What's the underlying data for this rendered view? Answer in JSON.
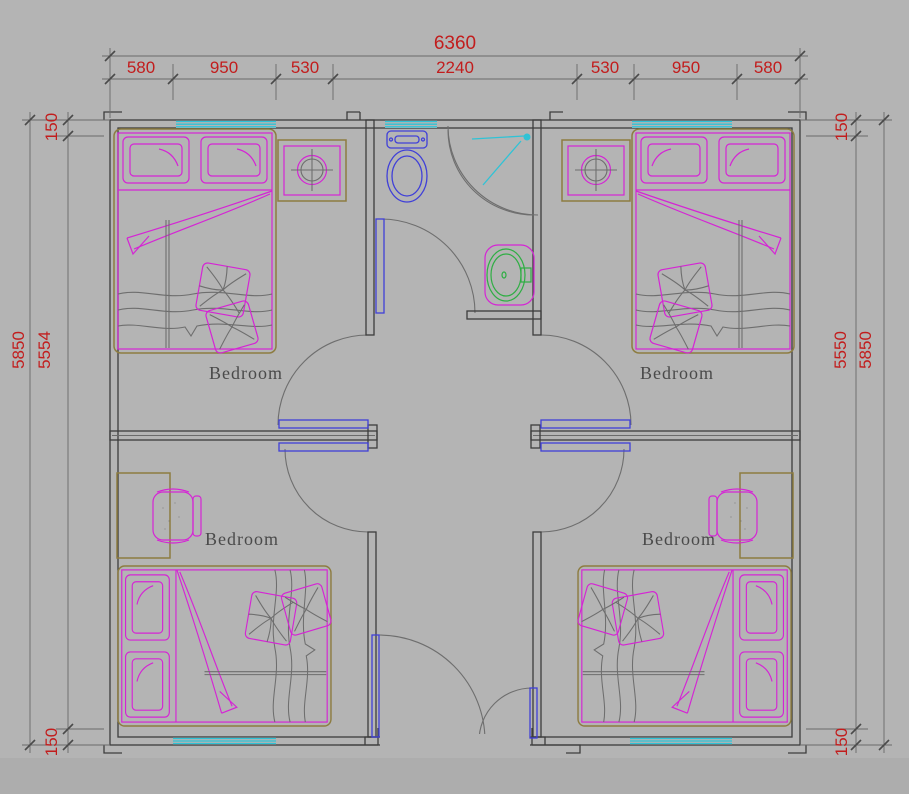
{
  "drawing": {
    "type": "architectural-floor-plan",
    "rooms": [
      {
        "label": "Bedroom"
      },
      {
        "label": "Bedroom"
      },
      {
        "label": "Bedroom"
      },
      {
        "label": "Bedroom"
      }
    ],
    "fixtures": [
      "double-bed",
      "double-bed",
      "double-bed",
      "double-bed",
      "bedside-table-with-lamp",
      "bedside-table-with-lamp",
      "desk-with-chair",
      "desk-with-chair",
      "toilet",
      "corner-shower",
      "washbasin",
      "window",
      "window",
      "window",
      "window",
      "window",
      "door-swing",
      "door-swing",
      "door-swing",
      "door-swing",
      "bathroom-door",
      "entry-double-door"
    ]
  },
  "dimensions": {
    "top": {
      "total": "6360",
      "segments": [
        "580",
        "950",
        "530",
        "2240",
        "530",
        "950",
        "580"
      ]
    },
    "left": {
      "overall": "5850",
      "chain": [
        "150",
        "5554",
        "150"
      ]
    },
    "right": {
      "overall": "5850",
      "chain": [
        "150",
        "5550",
        "150"
      ]
    }
  },
  "colors": {
    "background": "#b4b4b4",
    "wall": "#3d3d3d",
    "furniture_gray": "#6e6e6e",
    "dimension_red": "#c21d1d",
    "magenta": "#d524d5",
    "tan": "#8d7c40",
    "blue": "#4040d8",
    "cyan": "#2fc3d6",
    "green": "#2fae44",
    "label_gray": "#4a4a4a",
    "footer_strip": "#adadad"
  }
}
